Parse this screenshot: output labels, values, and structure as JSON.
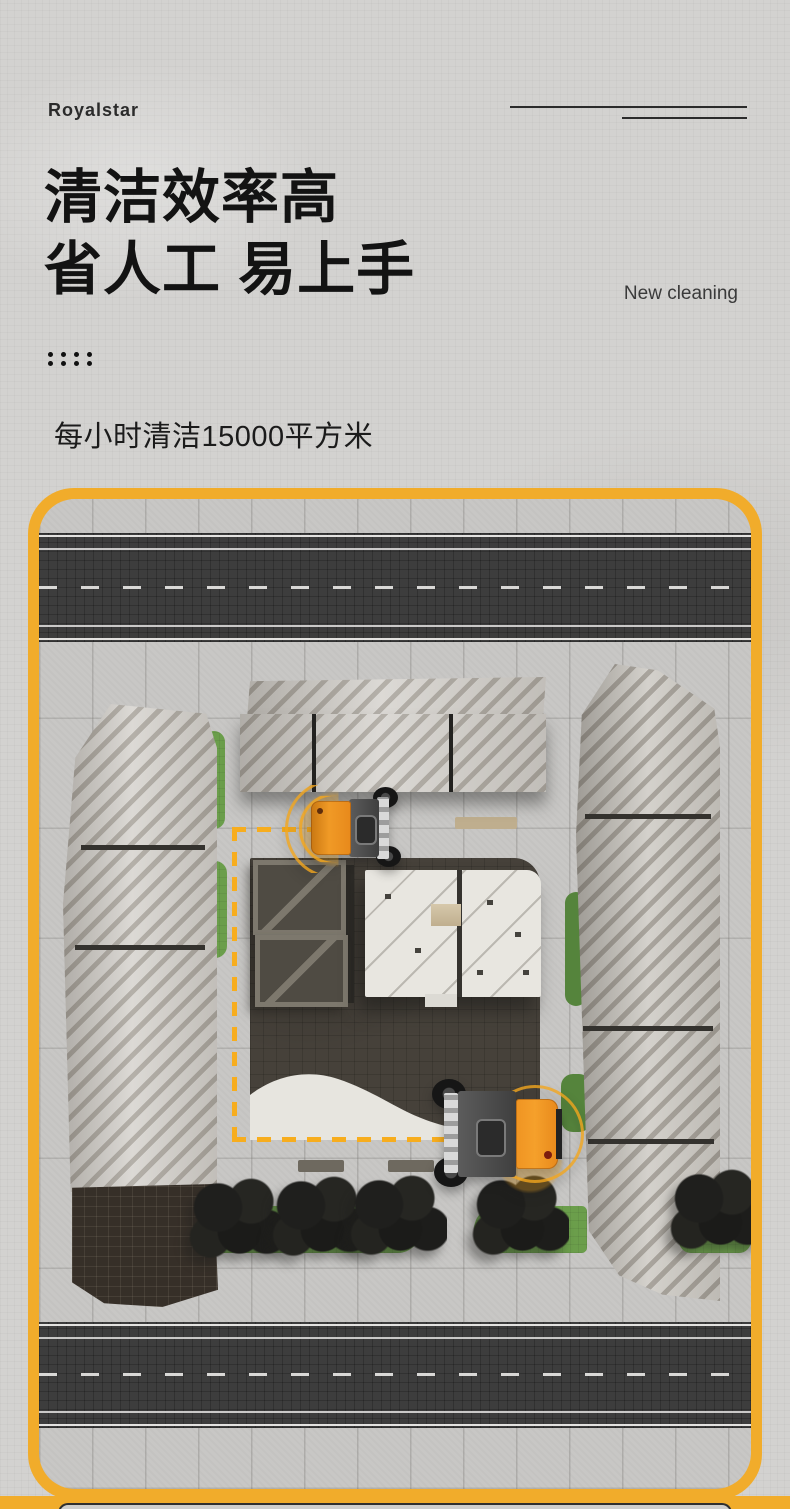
{
  "brand": {
    "logo_text": "Royalstar"
  },
  "hero": {
    "title_line1": "清洁效率高",
    "title_line2": "省人工 易上手",
    "tagline": "New cleaning",
    "metric": "每小时清洁15000平方米"
  },
  "colors": {
    "accent_yellow": "#F1AC2B",
    "route_dash_yellow": "#F7AD1E",
    "vehicle_orange": "#EF9422",
    "grass_green": "#6B9E4B",
    "road_asphalt": "#3D3D3D",
    "page_background": "#D3D2D0",
    "heading_text": "#131313"
  }
}
